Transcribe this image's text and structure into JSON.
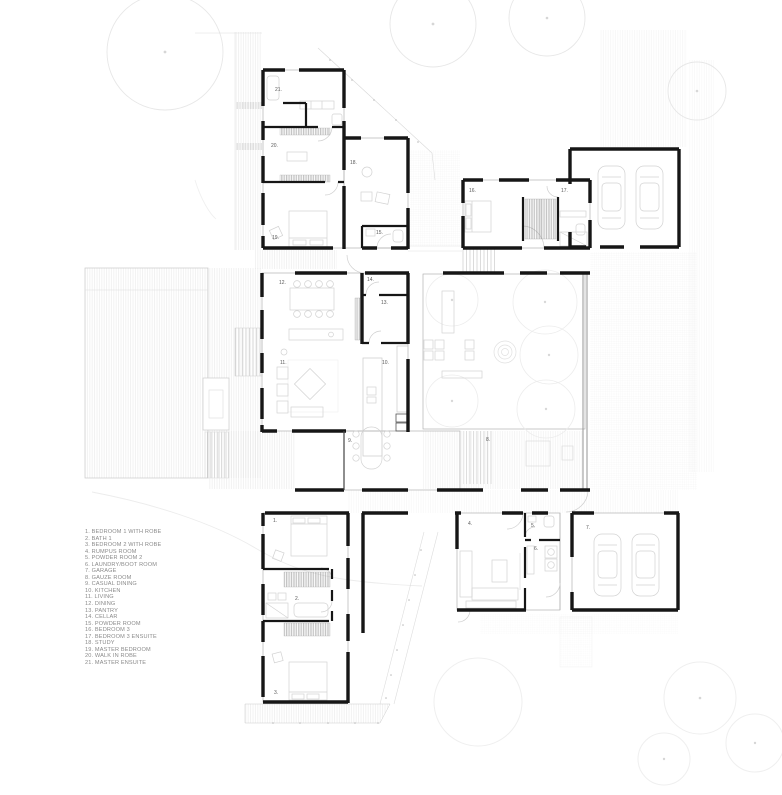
{
  "document": {
    "type": "architectural floor plan",
    "background": "#ffffff"
  },
  "colors": {
    "wall": "#161616",
    "thin_line": "#b3b3b3",
    "furniture": "#d2d2d2",
    "deck_hatch": "#e4e4e4",
    "tree": "#e7e7e7",
    "label_text": "#5a5a5a",
    "legend_text": "#8a8a8a"
  },
  "legend": {
    "items": [
      "1. BEDROOM 1 WITH ROBE",
      "2. BATH 1",
      "3. BEDROOM 2 WITH ROBE",
      "4. RUMPUS ROOM",
      "5. POWDER ROOM 2",
      "6. LAUNDRY/BOOT ROOM",
      "7. GARAGE",
      "8. GAUZE ROOM",
      "9. CASUAL DINING",
      "10. KITCHEN",
      "11. LIVING",
      "12. DINING",
      "13. PANTRY",
      "14. CELLAR",
      "15. POWDER ROOM",
      "16. BEDROOM 3",
      "17. BEDROOM 3 ENSUITE",
      "18. STUDY",
      "19. MASTER BEDROOM",
      "20. WALK IN ROBE",
      "21. MASTER ENSUITE"
    ]
  },
  "plan": {
    "room_labels": [
      "1.",
      "2.",
      "3.",
      "4.",
      "5.",
      "6.",
      "7.",
      "8.",
      "9.",
      "10.",
      "11.",
      "12.",
      "13.",
      "14.",
      "15.",
      "16.",
      "17.",
      "18.",
      "19.",
      "20.",
      "21."
    ]
  }
}
